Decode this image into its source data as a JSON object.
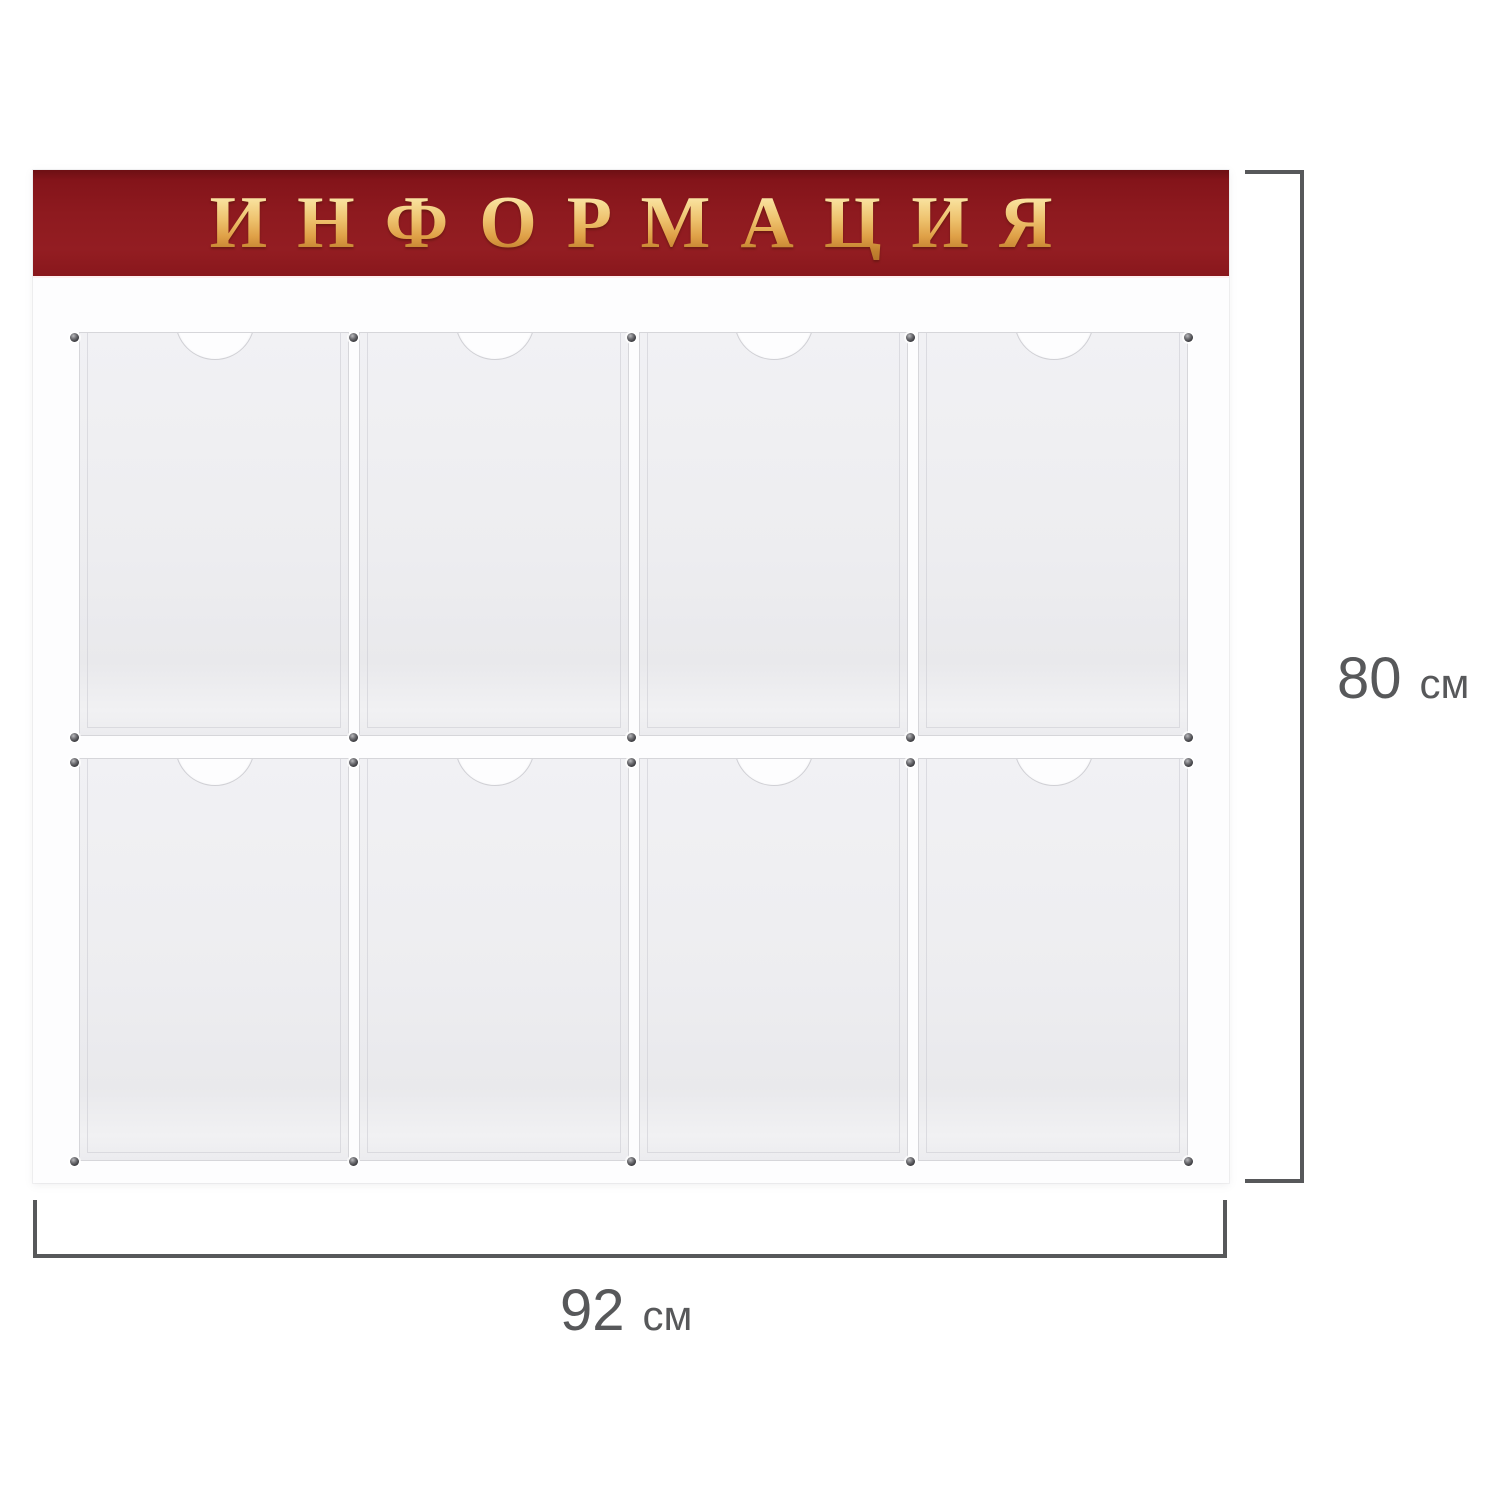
{
  "banner": {
    "label": "ИНФОРМАЦИЯ"
  },
  "pockets": {
    "rows": 2,
    "columns": 4,
    "count": 8
  },
  "dimensions": {
    "height": {
      "value": "80",
      "unit": "см"
    },
    "width": {
      "value": "92",
      "unit": "см"
    }
  },
  "colors": {
    "banner_red": "#8e1a1f",
    "banner_red_dark": "#6d0f13",
    "gold_light": "#fdf3c8",
    "gold_mid": "#eec26e",
    "gold_dark": "#b5762a",
    "dimension_gray": "#57585a",
    "pocket_gray": "#ededf0",
    "board_white": "#fdfdfe"
  }
}
